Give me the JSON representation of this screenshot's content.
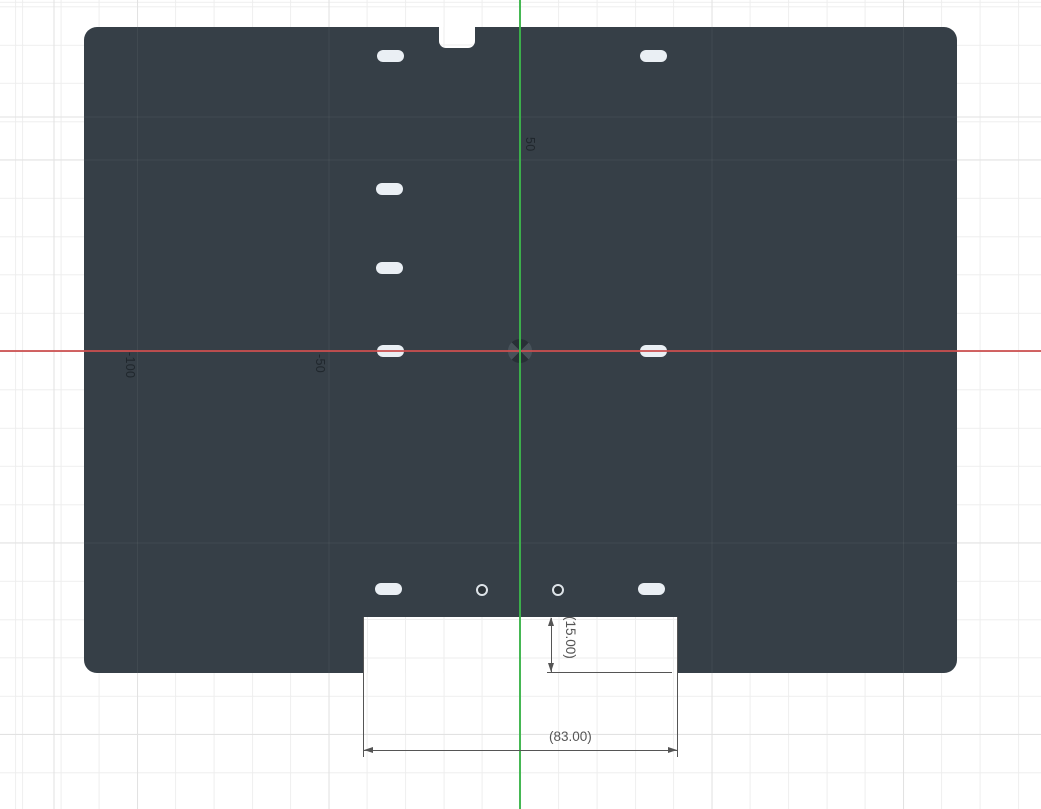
{
  "viewport": {
    "width": 1041,
    "height": 809,
    "kind": "cad-sketch-canvas"
  },
  "colors": {
    "bg": "#ffffff",
    "grid_minor": "#eeeeee",
    "grid_major": "#e2e2e2",
    "plate": "#363f47",
    "plate_gridline": "rgba(255,255,255,0.05)",
    "slot": "#eaeff4",
    "hole_ring": "#dde3e8",
    "hole_center": "#2b3237",
    "axis_x": "#cc4f4f",
    "axis_y": "#3cb44b",
    "dim": "#555555",
    "axis_label": "#20272d"
  },
  "grid": {
    "minor_spacing_px": 38.3,
    "major_spacing_px": 191.5
  },
  "axes": {
    "x_axis_y_px": 351,
    "y_axis_x_px": 520,
    "origin": {
      "x_px": 520,
      "y_px": 351
    }
  },
  "axis_labels": [
    {
      "text": "50",
      "left": 536,
      "top": 137
    },
    {
      "text": "-50",
      "left": 326,
      "top": 354
    },
    {
      "text": "-100",
      "left": 136,
      "top": 352
    }
  ],
  "plate": {
    "x": 84,
    "y": 27,
    "width": 873,
    "height": 646,
    "corner_radius": 13
  },
  "features": {
    "notch": {
      "x": 439,
      "y": 27,
      "width": 36,
      "height": 21
    },
    "cutout": {
      "x": 363,
      "y": 617,
      "width": 315,
      "height": 56
    },
    "slot_size": {
      "width": 27,
      "height": 12
    },
    "slots": [
      {
        "cx": 390,
        "cy": 56
      },
      {
        "cx": 653,
        "cy": 56
      },
      {
        "cx": 389,
        "cy": 189
      },
      {
        "cx": 389,
        "cy": 268
      },
      {
        "cx": 390,
        "cy": 351
      },
      {
        "cx": 653,
        "cy": 351
      },
      {
        "cx": 388,
        "cy": 589
      },
      {
        "cx": 651,
        "cy": 589
      }
    ],
    "hole_diameter": 12,
    "holes": [
      {
        "cx": 482,
        "cy": 590
      },
      {
        "cx": 558,
        "cy": 590
      }
    ]
  },
  "dimensions": [
    {
      "label": "(15.00)",
      "orientation": "vertical"
    },
    {
      "label": "(83.00)",
      "orientation": "horizontal"
    }
  ]
}
